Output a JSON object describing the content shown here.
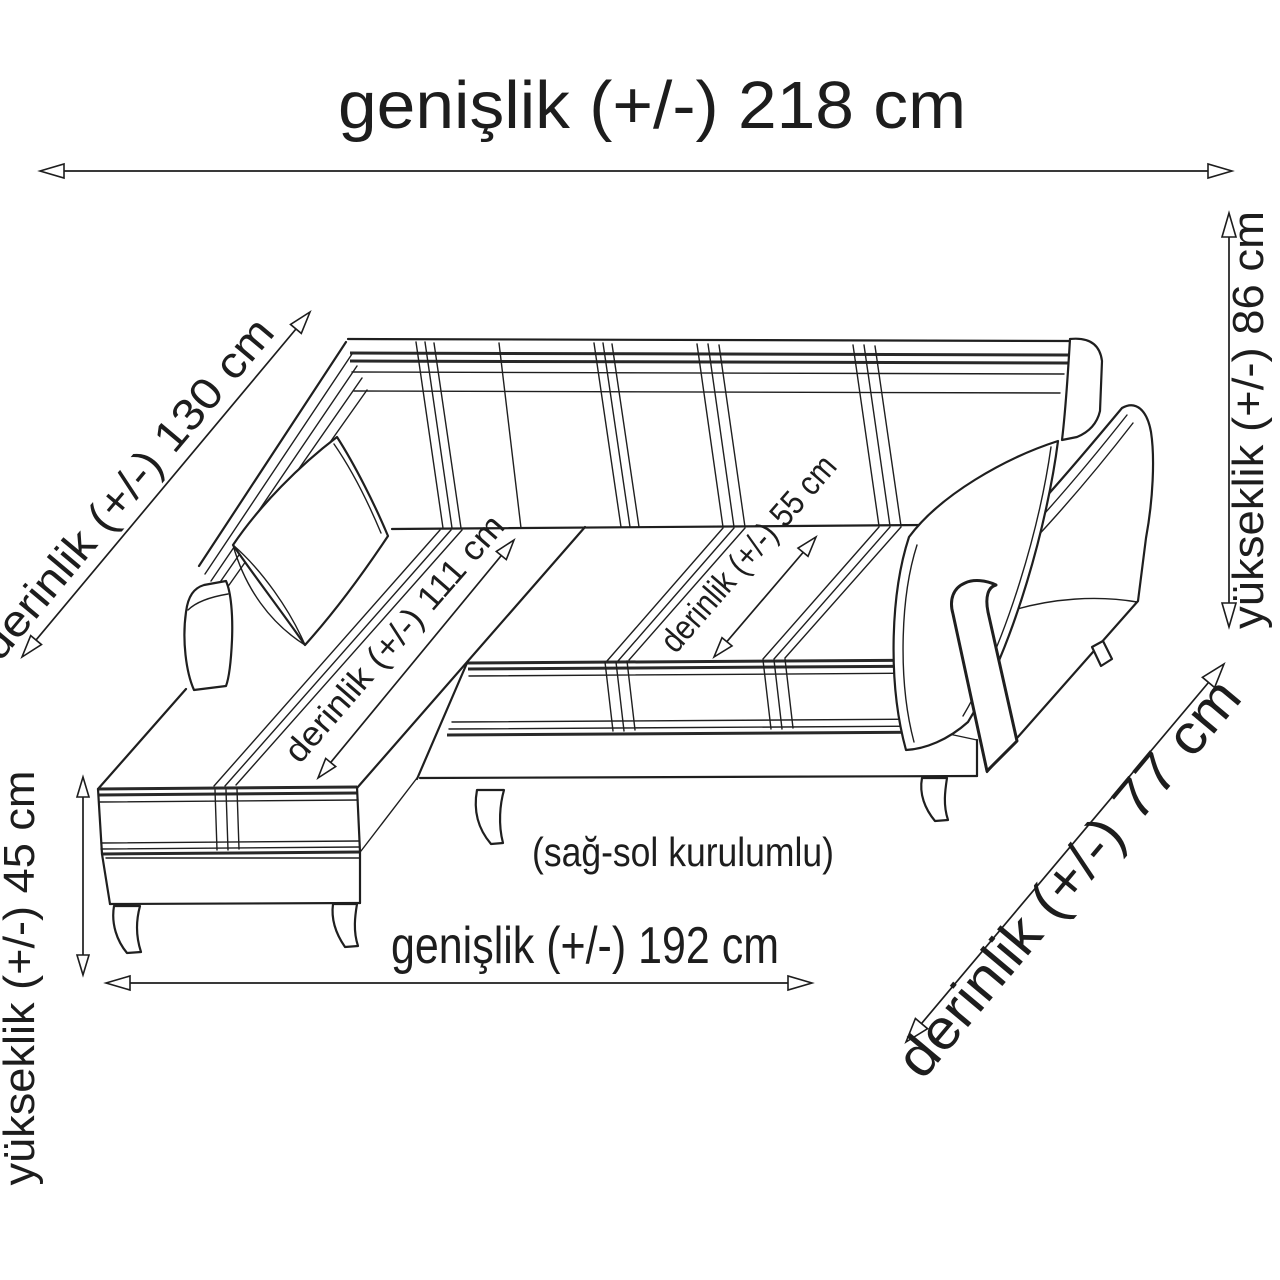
{
  "diagram": {
    "type": "furniture-dimension-drawing",
    "subject": "L-shaped corner sofa line drawing with dimension arrows",
    "note": "(sağ-sol kurulumlu)",
    "dimensions": {
      "top_width": "genişlik (+/-) 218 cm",
      "left_depth": "derinlik (+/-) 130 cm",
      "right_height": "yükseklik (+/-) 86 cm",
      "left_height": "yükseklik (+/-) 45 cm",
      "chaise_depth": "derinlik (+/-) 111 cm",
      "seat_depth": "derinlik (+/-) 55 cm",
      "bottom_width": "genişlik (+/-) 192 cm",
      "diagonal_depth": "derinlik (+/-) 77 cm"
    },
    "colors": {
      "background": "#ffffff",
      "line": "#1f1f1f",
      "text": "#1d1d1d"
    }
  }
}
